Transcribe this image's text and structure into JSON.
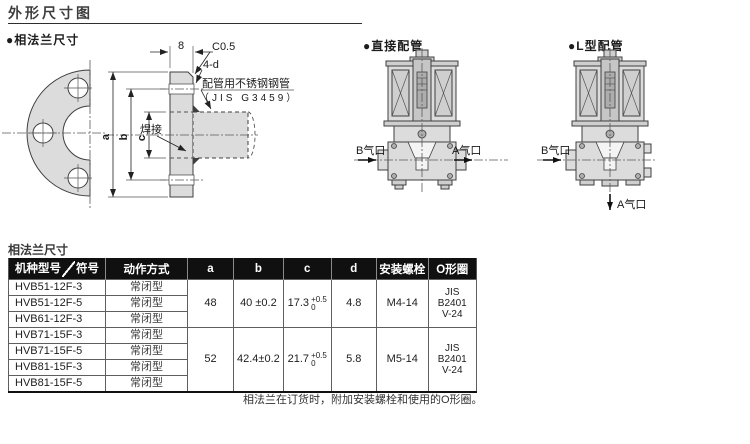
{
  "page": {
    "title": "外形尺寸图"
  },
  "colors": {
    "header_bg": "#101010",
    "paper": "#ffffff",
    "line": "#3f3f3f"
  },
  "flange_section": {
    "label": "●相法兰尺寸",
    "dims": {
      "thickness": "8",
      "chamfer": "C0.5",
      "holes": "4-d",
      "a": "a",
      "b": "b",
      "c": "c"
    },
    "pipe_note_1": "配管用不锈钢钢管",
    "pipe_note_2": "（JIS G3459）",
    "weld_label": "焊接"
  },
  "direct_section": {
    "label": "●直接配管",
    "port_b": "B气口",
    "port_a": "A气口"
  },
  "l_section": {
    "label": "●L型配管",
    "port_b": "B气口",
    "port_a": "A气口"
  },
  "spec_table": {
    "caption": "相法兰尺寸",
    "header": {
      "model": "机种型号",
      "symbol": "符号",
      "action": "动作方式",
      "a": "a",
      "b": "b",
      "c": "c",
      "d": "d",
      "bolt": "安装螺栓",
      "oring": "O形圈"
    },
    "groups": [
      {
        "rows": [
          {
            "model": "HVB51-12F-3",
            "action": "常闭型"
          },
          {
            "model": "HVB51-12F-5",
            "action": "常闭型"
          },
          {
            "model": "HVB61-12F-3",
            "action": "常闭型"
          }
        ],
        "a": "48",
        "b": "40 ±0.2",
        "c": "17.3",
        "c_tol_up": "+0.5",
        "c_tol_dn": "0",
        "d": "4.8",
        "bolt": "M4-14",
        "oring_1": "JIS B2401",
        "oring_2": "V-24"
      },
      {
        "rows": [
          {
            "model": "HVB71-15F-3",
            "action": "常闭型"
          },
          {
            "model": "HVB71-15F-5",
            "action": "常闭型"
          },
          {
            "model": "HVB81-15F-3",
            "action": "常闭型"
          },
          {
            "model": "HVB81-15F-5",
            "action": "常闭型"
          }
        ],
        "a": "52",
        "b": "42.4±0.2",
        "c": "21.7",
        "c_tol_up": "+0.5",
        "c_tol_dn": "0",
        "d": "5.8",
        "bolt": "M5-14",
        "oring_1": "JIS B2401",
        "oring_2": "V-24"
      }
    ],
    "note": "相法兰在订货时，附加安装螺栓和使用的O形圈。"
  }
}
